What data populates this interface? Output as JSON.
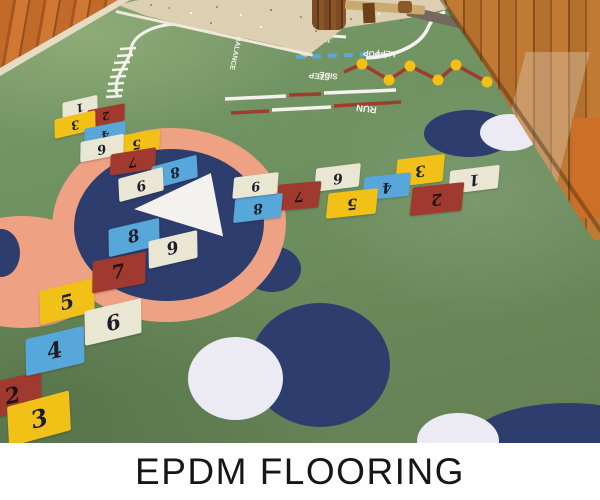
{
  "caption": {
    "title": "EPDM FLOORING"
  },
  "floor": {
    "markings": {
      "balance": "BALANCE",
      "jump": "JUMP",
      "left": "LEFT",
      "left_hoop": [
        "LEFT",
        "HOOP"
      ],
      "side_step": [
        "SIDE",
        "STEP"
      ],
      "run": "RUN"
    },
    "hopscotch": {
      "top_left_arm": [
        {
          "n": "1",
          "color": "cream"
        },
        {
          "n": "2",
          "color": "red"
        },
        {
          "n": "3",
          "color": "yellow"
        },
        {
          "n": "4",
          "color": "blue"
        },
        {
          "n": "5",
          "color": "yellow"
        },
        {
          "n": "6",
          "color": "cream"
        },
        {
          "n": "7",
          "color": "red"
        },
        {
          "n": "8",
          "color": "blue"
        },
        {
          "n": "9",
          "color": "cream"
        }
      ],
      "right_arm": [
        {
          "n": "1",
          "color": "cream"
        },
        {
          "n": "2",
          "color": "red"
        },
        {
          "n": "3",
          "color": "yellow"
        },
        {
          "n": "4",
          "color": "blue"
        },
        {
          "n": "5",
          "color": "yellow"
        },
        {
          "n": "6",
          "color": "cream"
        },
        {
          "n": "7",
          "color": "red"
        },
        {
          "n": "8",
          "color": "blue"
        },
        {
          "n": "9",
          "color": "cream"
        }
      ],
      "bottom_left_arm": [
        {
          "n": "2",
          "color": "red"
        },
        {
          "n": "3",
          "color": "yellow"
        },
        {
          "n": "4",
          "color": "blue"
        },
        {
          "n": "5",
          "color": "yellow"
        },
        {
          "n": "6",
          "color": "cream"
        },
        {
          "n": "7",
          "color": "red"
        },
        {
          "n": "8",
          "color": "blue"
        },
        {
          "n": "9",
          "color": "cream"
        }
      ]
    },
    "colors": {
      "grass_green": "#6e9160",
      "ring_salmon": "#efa183",
      "circle_navy": "#2d3d6d",
      "circle_white": "#eceaf2",
      "tile_yellow": "#f2c117",
      "tile_blue": "#57a7da",
      "tile_red": "#a03a2e",
      "tile_cream": "#e9e6d4",
      "line_white": "#f4f2ec",
      "dash_blue": "#5aa7dc",
      "zigzag_maroon": "#9e3c2e",
      "dot_yellow": "#f3c013",
      "sand": "#ddcfb2",
      "fence_wood": "#b4712e"
    }
  }
}
